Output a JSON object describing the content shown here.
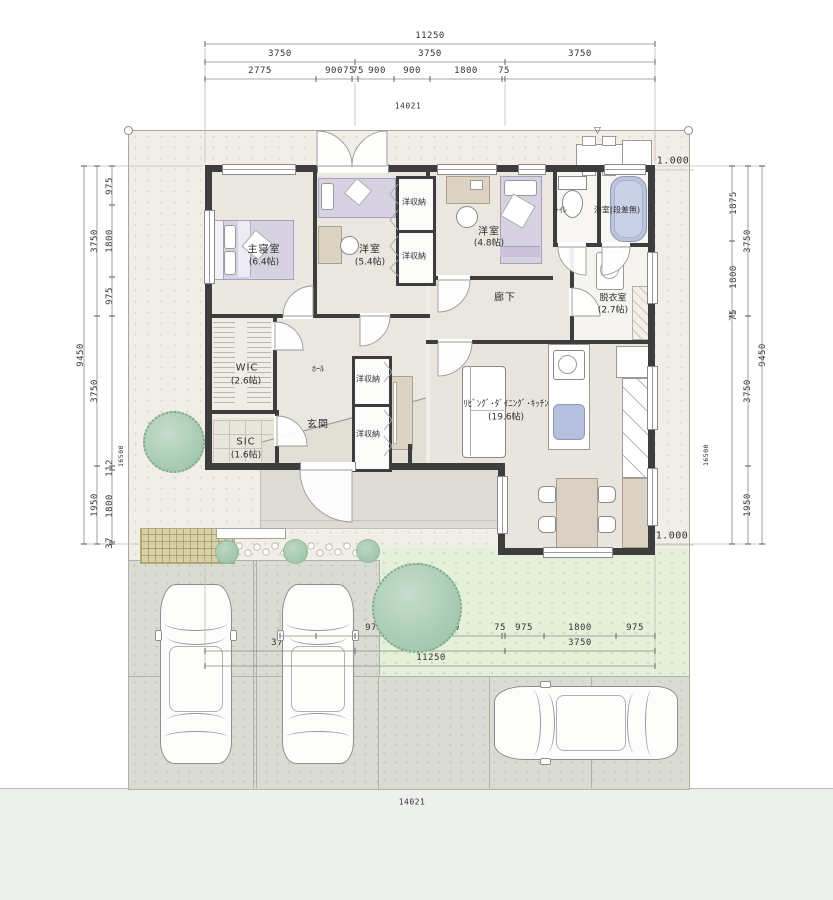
{
  "dims": {
    "top": {
      "total": "11250",
      "thirds": [
        "3750",
        "3750",
        "3750"
      ],
      "detail": [
        "2775",
        "900",
        "75",
        "75",
        "900",
        "900",
        "1800",
        "75"
      ]
    },
    "bottom": {
      "detail": [
        "900",
        "975",
        "975",
        "2700",
        "75",
        "975",
        "1800",
        "975"
      ],
      "thirds": [
        "3750",
        "3750",
        "3750"
      ],
      "total": "11250"
    },
    "left": {
      "upper": [
        "975",
        "1800",
        "975"
      ],
      "lower": [
        "112",
        "1800",
        "37"
      ],
      "mid": [
        "3750",
        "3750",
        "1950"
      ],
      "total": "9450",
      "site": "16500"
    },
    "right": {
      "upper": [
        "1875",
        "1800",
        "75"
      ],
      "mid": [
        "3750",
        "3750",
        "1950"
      ],
      "total": "9450",
      "site": "16500"
    },
    "site_width": "14021",
    "level_top": "1.000",
    "level_bottom": "1.000"
  },
  "rooms": {
    "master": {
      "name": "主寝室",
      "size": "(6.4帖)"
    },
    "west54": {
      "name": "洋室",
      "size": "(5.4帖)"
    },
    "west48": {
      "name": "洋室",
      "size": "(4.8帖)"
    },
    "wic": {
      "name": "WIC",
      "size": "(2.6帖)"
    },
    "sic": {
      "name": "SIC",
      "size": "(1.6帖)"
    },
    "hall": {
      "name": "ﾎｰﾙ"
    },
    "genkan": {
      "name": "玄関"
    },
    "corridor": {
      "name": "廊下"
    },
    "toilet": {
      "name": "ﾄｲﾚ"
    },
    "bath": {
      "name": "浴室(段差無)"
    },
    "wash": {
      "name": "脱衣室",
      "size": "(2.7帖)"
    },
    "ldk": {
      "name": "ﾘﾋﾞﾝｸﾞ･ﾀﾞｲﾆﾝｸﾞ･ｷｯﾁﾝ",
      "size": "(19.6帖)"
    },
    "closet": {
      "name": "洋収納"
    }
  },
  "decor": {
    "marker": "▽"
  },
  "colors": {
    "wall": "#3d3d3d",
    "bed": "#d6d2e2",
    "bath_blue": "#bac4dc",
    "lawn": "#e4f0da",
    "site": "#f1eee7",
    "parking": "#dadcd4"
  }
}
